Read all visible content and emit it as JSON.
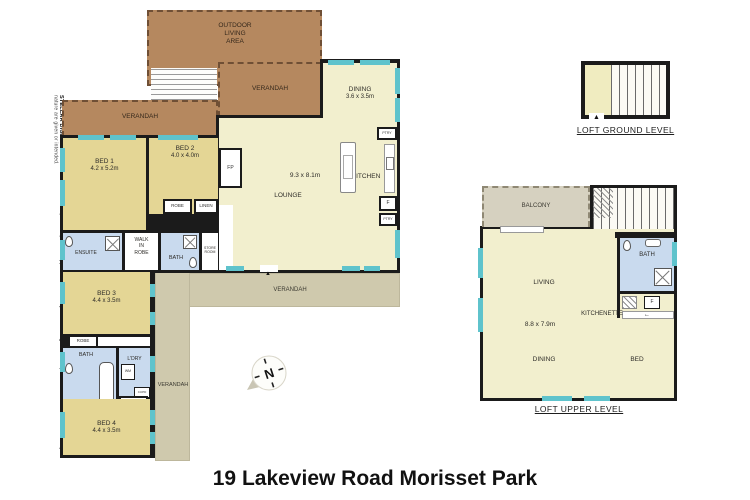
{
  "title": "19 Lakeview Road Morisset Park",
  "watermark": {
    "brand": "STELLAR DIGITAL",
    "disclaimer": " Measurements in this floor plan/site plan are approximate and only meant as a guide. No representations or warranties of any nature are given or intended."
  },
  "colors": {
    "wall": "#1b1b1b",
    "living_cream": "#f2efce",
    "bedroom_tan": "#e4d695",
    "deck_brown": "#b5885f",
    "verandah_grey": "#cfc9ad",
    "bath_blue": "#c9daee",
    "window_teal": "#5fc3cc",
    "balcony_grey": "#d6d1c0"
  },
  "icons": {
    "up_arrow": "▲",
    "left_arrow": "←"
  },
  "main_floor": {
    "outdoor_living": "OUTDOOR\nLIVING\nAREA",
    "verandah_top": "VERANDAH",
    "verandah_left": "VERANDAH",
    "verandah_rear": "VERANDAH",
    "verandah_side": "VERANDAH",
    "bed1_name": "BED 1",
    "bed1_dims": "4.2 x 5.2m",
    "bed2_name": "BED 2",
    "bed2_dims": "4.0 x 4.0m",
    "robe_bed2": "ROBE",
    "linen": "LINEN",
    "ensuite": "ENSUITE",
    "walk_in_robe": "WALK\nIN\nROBE",
    "bath": "BATH",
    "store_room": "STORE\nROOM",
    "fireplace": "FP",
    "dining_name": "DINING",
    "dining_dims": "3.6 x 3.5m",
    "living_dims": "9.3 x 8.1m",
    "lounge": "LOUNGE",
    "kitchen": "KITCHEN",
    "pantry_top": "PTRY",
    "fridge": "F",
    "pantry_bottom": "PTRY",
    "bed3_name": "BED 3",
    "bed3_dims": "4.4 x 3.5m",
    "robe_bed3": "ROBE",
    "bath2": "BATH",
    "laundry": "L'DRY",
    "washing_machine": "WM",
    "cupboard": "CUPD",
    "robe_bed4": "ROBE",
    "bed4_name": "BED 4",
    "bed4_dims": "4.4 x 3.5m"
  },
  "loft_ground": {
    "caption": "LOFT GROUND LEVEL"
  },
  "loft_upper": {
    "caption": "LOFT UPPER LEVEL",
    "balcony": "BALCONY",
    "living": "LIVING",
    "dims": "8.8 x 7.9m",
    "dining": "DINING",
    "bed": "BED",
    "bath": "BATH",
    "kitchenette": "KITCHENETTE",
    "fridge": "F"
  },
  "compass": {
    "north": "N"
  }
}
